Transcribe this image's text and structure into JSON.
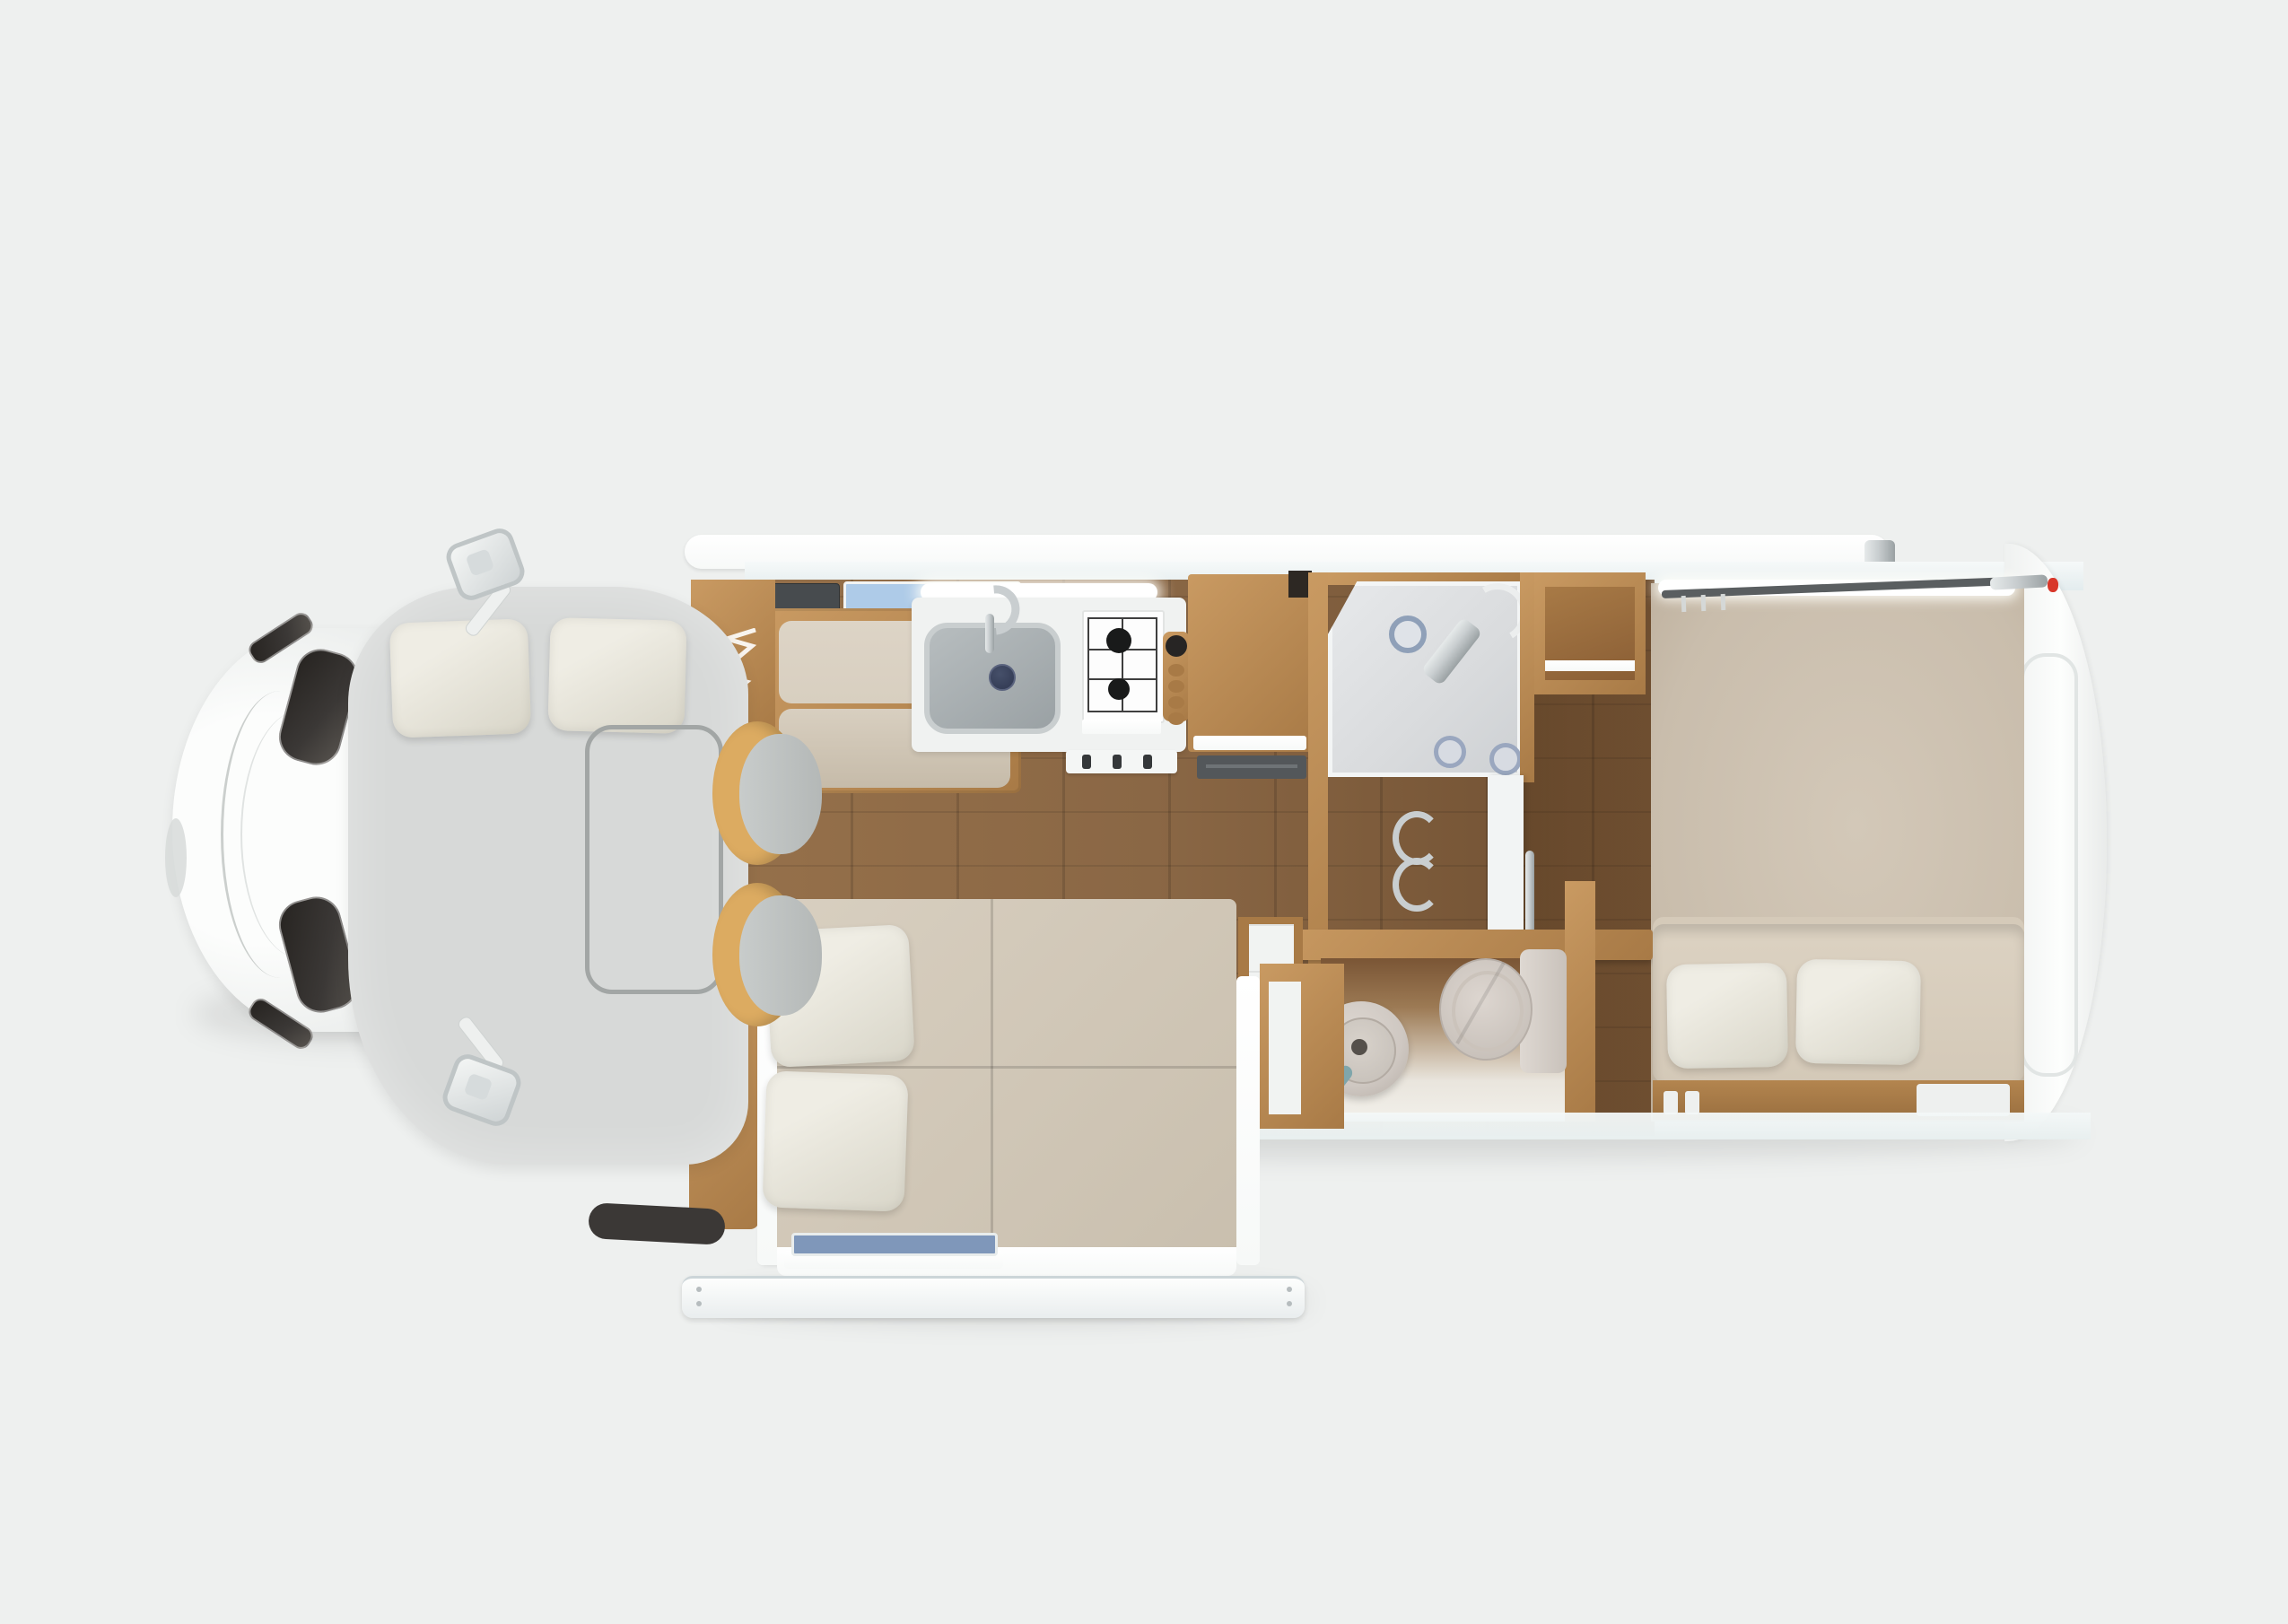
{
  "scene": {
    "title": "Motorhome floor plan — top-down 3D render",
    "view": "top view cutaway",
    "has_text": false
  },
  "areas": {
    "cab": {
      "label": "Driver cab"
    },
    "overcab": {
      "label": "Cab-over bed with pillows"
    },
    "lounge": {
      "label": "Front bench dinette"
    },
    "kitchen": {
      "label": "Kitchen with sink and gas stove"
    },
    "shower": {
      "label": "Shower cabin"
    },
    "wardrobe": {
      "label": "Wardrobe cabinet"
    },
    "bathroom": {
      "label": "Bathroom with toilet and basin"
    },
    "bedroom": {
      "label": "Rear bedroom"
    },
    "slideout": {
      "label": "Slide-out bed"
    },
    "awning": {
      "label": "Awning bar"
    }
  },
  "counts": {
    "stove_burners": 2,
    "stove_knobs": 3,
    "overcab_pillows": 2,
    "bedroom_pillows": 2,
    "slideout_pillows": 2,
    "swivel_chairs": 2,
    "mirrors": 2
  },
  "theme": {
    "bg": "#eef0ef",
    "coach_white": "#f7f9f8",
    "roof_tint": "#e3ecee",
    "sill": "#e8efef",
    "mat_gray": "#d7d9d8",
    "pillow_light": "#efede4",
    "pillow_shade": "#d8d5c8",
    "wood_floor": "#8a6745",
    "wood_floor_dark": "#6e4e30",
    "wood_cabinet": "#c99a62",
    "wood_cabinet_dark": "#a87a46",
    "counter_white": "#f0f2f1",
    "sink_steel": "#9aa1a4",
    "steel_dark": "#53575a",
    "burner_black": "#191a1a",
    "glass_dark": "#3b3836",
    "cushion_beige": "#d8cfc0",
    "cushion_dark": "#c6bba9",
    "chair_tan": "#dcab61",
    "seat_gray": "#b4b8b7",
    "shower_gray": "#d9dbdd",
    "ceramic": "#cfc8c2",
    "bedroom_carpet": "#c9bdac",
    "mattress_beige": "#d4c9b8",
    "window_blue": "#aecbe8",
    "slideout_window_blue": "#7f97ba",
    "chrome": "#c9ced0",
    "red_marker": "#d8372a",
    "led_white": "#ffffff"
  }
}
